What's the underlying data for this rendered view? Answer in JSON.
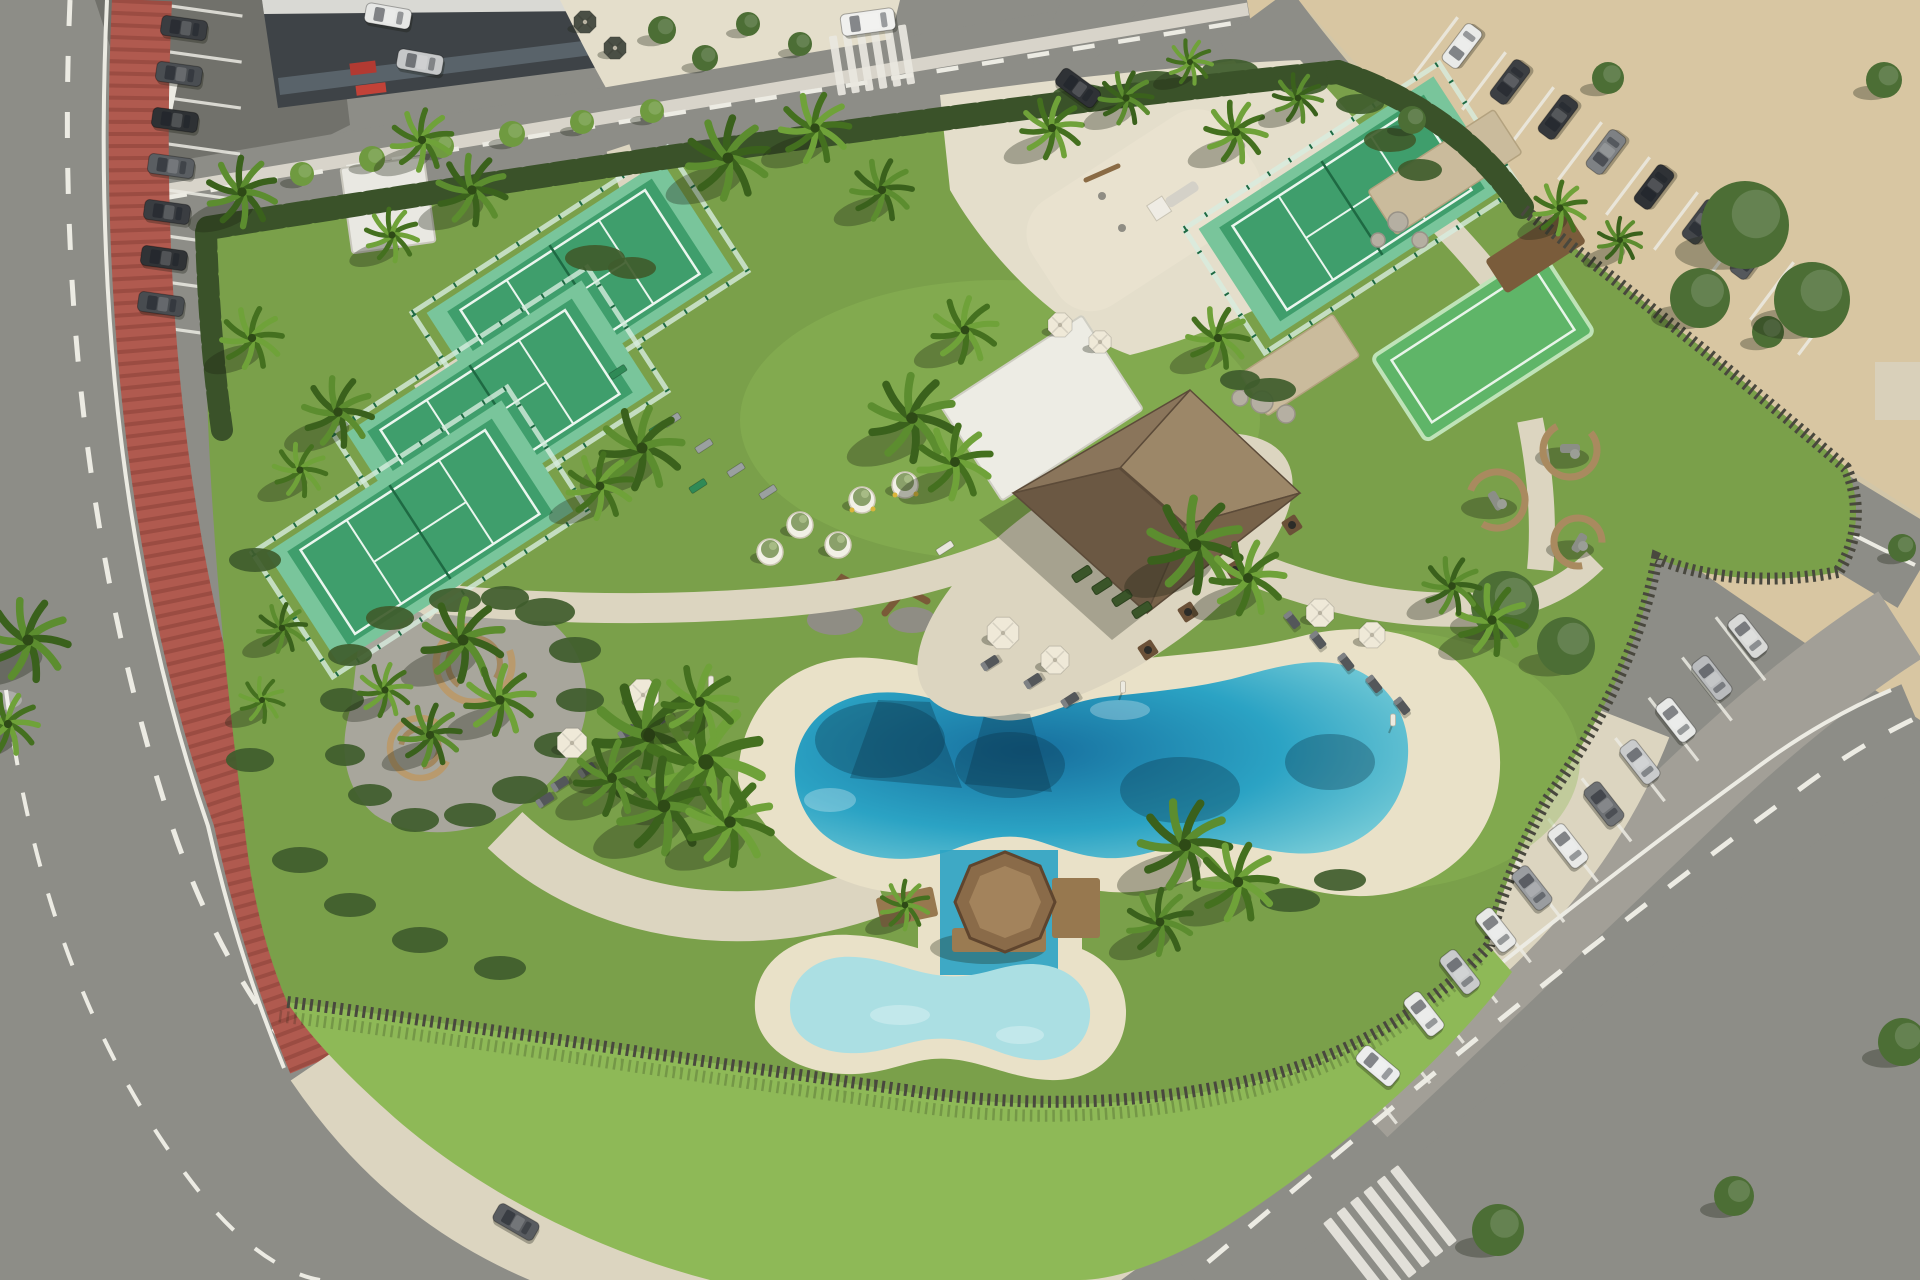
{
  "description": "Aerial drone view of a coastal resort leisure park with padel courts, lagoon pool, kids pool with octagonal wooden deck, thatched-roof pavilion, playground, palm trees, red bike lane on curved road, and car parking lots along a sandy beach strip",
  "palette": {
    "asphalt": "#80807a",
    "road": "#8d8d87",
    "asphalt_dark": "#71716b",
    "parking_light": "#a29f97",
    "sand_lot": "#d8c6a2",
    "walk": "#dcd5c0",
    "plaza": "#e4decb",
    "beach": "#e9e1c8",
    "grass": "#7aa04a",
    "grass_bright": "#8eb957",
    "grass_dark": "#5f853c",
    "hedge": "#3a5229",
    "shrub": "#3f5c2c",
    "fence": "#49483e",
    "bike": "#b05a4f",
    "road_line": "#ecebe3",
    "court_green": "#3f9e6c",
    "court_light": "#79c59b",
    "court_line": "#eaf6ee",
    "court_fence": "#1e6a43",
    "glass": "#d7ecdf",
    "pool_deep": "#176f9e",
    "pool_mid": "#2ba3c4",
    "pool_light": "#7fd0d9",
    "kids_pool": "#abdfe3",
    "wood": "#8e6f4e",
    "wood_dark": "#6b5138",
    "roof_n": "#9c8768",
    "roof_e": "#776249",
    "roof_s": "#6b5843",
    "roof_w": "#8a755b",
    "roof_edge": "#5c4b39",
    "bldg_white": "#edece4",
    "bldg_dark": "#3e4347",
    "glass_dark": "#59636a",
    "stone": "#cabb9c",
    "boulder": "#b5afa2",
    "gravel": "#a8a69c",
    "trunk": "#7d6b4c",
    "tree_dark": "#4c6e35",
    "tree_bright": "#6f9a40",
    "umbrella_cream": "#efe9d8",
    "umbrella_dark": "#4a4f45",
    "lounger": "#54575a",
    "red_accent": "#b23a32",
    "shadow": "rgba(28,33,18,0.32)"
  },
  "scene": {
    "palms": [
      [
        242,
        192,
        34,
        0
      ],
      [
        252,
        338,
        30,
        1
      ],
      [
        338,
        412,
        34,
        0
      ],
      [
        300,
        470,
        26,
        1
      ],
      [
        422,
        140,
        30,
        1
      ],
      [
        472,
        190,
        34,
        0
      ],
      [
        392,
        235,
        26,
        1
      ],
      [
        728,
        158,
        40,
        0
      ],
      [
        815,
        128,
        34,
        1
      ],
      [
        882,
        190,
        30,
        0
      ],
      [
        642,
        448,
        40,
        0
      ],
      [
        600,
        486,
        32,
        1
      ],
      [
        912,
        418,
        42,
        0
      ],
      [
        955,
        462,
        36,
        1
      ],
      [
        965,
        330,
        32,
        1
      ],
      [
        1052,
        128,
        30,
        1
      ],
      [
        1126,
        98,
        26,
        0
      ],
      [
        1236,
        132,
        30,
        1
      ],
      [
        1298,
        98,
        24,
        0
      ],
      [
        1190,
        62,
        22,
        1
      ],
      [
        1218,
        338,
        30,
        1
      ],
      [
        1195,
        545,
        46,
        0
      ],
      [
        1248,
        578,
        36,
        1
      ],
      [
        463,
        640,
        40,
        0
      ],
      [
        500,
        700,
        34,
        1
      ],
      [
        430,
        735,
        30,
        0
      ],
      [
        385,
        690,
        26,
        1
      ],
      [
        282,
        628,
        24,
        0
      ],
      [
        262,
        700,
        22,
        1
      ],
      [
        648,
        735,
        52,
        0
      ],
      [
        706,
        762,
        56,
        1
      ],
      [
        664,
        806,
        46,
        0
      ],
      [
        730,
        822,
        42,
        1
      ],
      [
        612,
        778,
        36,
        0
      ],
      [
        700,
        702,
        36,
        1
      ],
      [
        1185,
        845,
        44,
        0
      ],
      [
        1238,
        882,
        38,
        1
      ],
      [
        1160,
        922,
        32,
        0
      ],
      [
        1492,
        620,
        34,
        1
      ],
      [
        1452,
        586,
        28,
        0
      ],
      [
        1560,
        208,
        26,
        1
      ],
      [
        1620,
        240,
        22,
        0
      ],
      [
        28,
        640,
        40,
        0
      ],
      [
        8,
        724,
        30,
        1
      ],
      [
        905,
        905,
        24,
        1
      ]
    ],
    "trees": [
      [
        302,
        174,
        12,
        1
      ],
      [
        372,
        159,
        13,
        1
      ],
      [
        442,
        146,
        12,
        1
      ],
      [
        512,
        134,
        13,
        1
      ],
      [
        582,
        122,
        12,
        1
      ],
      [
        652,
        111,
        12,
        1
      ],
      [
        662,
        30,
        14,
        0
      ],
      [
        705,
        58,
        13,
        0
      ],
      [
        748,
        24,
        12,
        0
      ],
      [
        800,
        44,
        12,
        0
      ],
      [
        1608,
        78,
        16,
        0
      ],
      [
        1884,
        80,
        18,
        0
      ],
      [
        1768,
        332,
        16,
        0
      ],
      [
        1902,
        548,
        14,
        0
      ],
      [
        1745,
        225,
        44,
        0
      ],
      [
        1812,
        300,
        38,
        0
      ],
      [
        1700,
        298,
        30,
        0
      ],
      [
        1505,
        605,
        34,
        0
      ],
      [
        1566,
        646,
        29,
        0
      ],
      [
        1412,
        120,
        14,
        0
      ],
      [
        1498,
        1230,
        26,
        0
      ],
      [
        1734,
        1196,
        20,
        0
      ],
      [
        1902,
        1042,
        24,
        0
      ]
    ],
    "shrubs": [
      [
        545,
        612,
        30,
        14
      ],
      [
        575,
        650,
        26,
        13
      ],
      [
        580,
        700,
        24,
        12
      ],
      [
        560,
        745,
        26,
        13
      ],
      [
        520,
        790,
        28,
        14
      ],
      [
        470,
        815,
        26,
        12
      ],
      [
        415,
        820,
        24,
        12
      ],
      [
        370,
        795,
        22,
        11
      ],
      [
        345,
        755,
        20,
        11
      ],
      [
        342,
        700,
        22,
        12
      ],
      [
        350,
        655,
        22,
        11
      ],
      [
        390,
        618,
        24,
        12
      ],
      [
        455,
        600,
        26,
        12
      ],
      [
        505,
        598,
        24,
        12
      ],
      [
        595,
        258,
        30,
        13
      ],
      [
        632,
        268,
        24,
        11
      ],
      [
        1082,
        96,
        30,
        12
      ],
      [
        1156,
        82,
        28,
        11
      ],
      [
        1230,
        70,
        28,
        11
      ],
      [
        1302,
        84,
        26,
        11
      ],
      [
        1360,
        104,
        24,
        10
      ],
      [
        1390,
        140,
        26,
        12
      ],
      [
        1420,
        170,
        22,
        11
      ],
      [
        1270,
        390,
        26,
        12
      ],
      [
        1240,
        380,
        20,
        10
      ],
      [
        1290,
        900,
        30,
        12
      ],
      [
        1340,
        880,
        26,
        11
      ],
      [
        255,
        560,
        26,
        12
      ],
      [
        250,
        760,
        24,
        12
      ],
      [
        300,
        860,
        28,
        13
      ],
      [
        350,
        905,
        26,
        12
      ],
      [
        420,
        940,
        28,
        13
      ],
      [
        500,
        968,
        26,
        12
      ]
    ],
    "padel_courts": [
      {
        "x": 580,
        "y": 292,
        "rot": -33
      },
      {
        "x": 500,
        "y": 412,
        "rot": -33
      },
      {
        "x": 420,
        "y": 532,
        "rot": -33
      },
      {
        "x": 1352,
        "y": 208,
        "rot": -33
      }
    ],
    "cars": [
      [
        184,
        28,
        8,
        "#3a3d41"
      ],
      [
        179,
        74,
        8,
        "#4a4e52"
      ],
      [
        175,
        120,
        8,
        "#2e3134"
      ],
      [
        171,
        166,
        8,
        "#5a5e62"
      ],
      [
        167,
        212,
        8,
        "#3a3d41"
      ],
      [
        164,
        258,
        8,
        "#303336"
      ],
      [
        161,
        304,
        8,
        "#484c50"
      ],
      [
        420,
        62,
        10,
        "#c6c8c9"
      ],
      [
        388,
        16,
        10,
        "#e6e7e5"
      ],
      [
        868,
        22,
        -8,
        "#f0f0ee",
        "van"
      ],
      [
        1078,
        88,
        36,
        "#2f3236"
      ],
      [
        516,
        1222,
        30,
        "#595c60"
      ],
      [
        1462,
        46,
        -53,
        "#e9eae8"
      ],
      [
        1510,
        82,
        -53,
        "#3c3f43"
      ],
      [
        1558,
        117,
        -53,
        "#35383c"
      ],
      [
        1606,
        152,
        -53,
        "#7e8184"
      ],
      [
        1654,
        187,
        -53,
        "#2f3236"
      ],
      [
        1702,
        222,
        -53,
        "#43464a"
      ],
      [
        1750,
        257,
        -53,
        "#55585c"
      ],
      [
        1798,
        292,
        -53,
        "#303337"
      ],
      [
        1378,
        1066,
        40,
        "#eceded"
      ],
      [
        1424,
        1014,
        52,
        "#e8e9e7"
      ],
      [
        1460,
        972,
        52,
        "#c9cbcc"
      ],
      [
        1496,
        930,
        52,
        "#e8e9e7"
      ],
      [
        1532,
        888,
        52,
        "#9a9da0"
      ],
      [
        1568,
        846,
        52,
        "#e8e9e7"
      ],
      [
        1604,
        804,
        52,
        "#6e7174"
      ],
      [
        1640,
        762,
        52,
        "#c9cbcc"
      ],
      [
        1676,
        720,
        52,
        "#e8e9e7"
      ],
      [
        1712,
        678,
        52,
        "#b9bbbd"
      ],
      [
        1748,
        636,
        52,
        "#d8d9d7"
      ]
    ],
    "stall_rows": [
      {
        "x": 1372,
        "y": 1092,
        "dx": 33.5,
        "dy": -40.3,
        "n": 12,
        "rot": 52,
        "len": 80
      },
      {
        "x": 1436,
        "y": 46,
        "dx": 48,
        "dy": 35,
        "n": 9,
        "rot": -53,
        "len": 72
      },
      {
        "x": 185,
        "y": 8,
        "dx": -0.8,
        "dy": 46,
        "n": 8,
        "rot": 8,
        "len": 116
      }
    ],
    "crosswalks": [
      {
        "x": 872,
        "y": 60,
        "dir": -9,
        "n": 6,
        "step": 14,
        "bw": 8,
        "bl": 60
      },
      {
        "x": 1390,
        "y": 1232,
        "dir": -38,
        "n": 6,
        "step": 17,
        "bw": 10,
        "bl": 96
      }
    ],
    "umbrellas": [
      [
        643,
        695,
        17,
        "cream"
      ],
      [
        572,
        743,
        16,
        "cream"
      ],
      [
        1003,
        633,
        17,
        "cream"
      ],
      [
        1055,
        660,
        15,
        "cream"
      ],
      [
        1320,
        613,
        15,
        "cream"
      ],
      [
        1372,
        635,
        14,
        "cream"
      ],
      [
        1060,
        325,
        13,
        "cream"
      ],
      [
        1100,
        342,
        12,
        "cream"
      ],
      [
        585,
        22,
        12,
        "dark"
      ],
      [
        615,
        48,
        12,
        "dark"
      ]
    ],
    "loungers": [
      [
        663,
        718,
        -33
      ],
      [
        627,
        732,
        -33
      ],
      [
        587,
        770,
        -33
      ],
      [
        560,
        784,
        -33
      ],
      [
        545,
        800,
        -33
      ],
      [
        990,
        663,
        -33
      ],
      [
        1033,
        681,
        -33
      ],
      [
        1070,
        700,
        -33
      ],
      [
        1292,
        620,
        52
      ],
      [
        1318,
        640,
        52
      ],
      [
        1346,
        662,
        52
      ],
      [
        1374,
        684,
        52
      ],
      [
        1402,
        706,
        52
      ]
    ],
    "benches": [
      [
        618,
        372,
        -33,
        "g"
      ],
      [
        658,
        428,
        -33,
        "g"
      ],
      [
        698,
        486,
        -33,
        "g"
      ],
      [
        672,
        420,
        -33,
        "gy"
      ],
      [
        704,
        446,
        -33,
        "gy"
      ],
      [
        736,
        470,
        -33,
        "gy"
      ],
      [
        768,
        492,
        -33,
        "gy"
      ],
      [
        945,
        548,
        -33,
        "w"
      ]
    ],
    "planters": [
      [
        800,
        525,
        0
      ],
      [
        862,
        500,
        1
      ],
      [
        905,
        485,
        1
      ],
      [
        770,
        552,
        0
      ],
      [
        838,
        545,
        0
      ]
    ],
    "planter_boxes": [
      [
        1082,
        574
      ],
      [
        1102,
        586
      ],
      [
        1122,
        598
      ],
      [
        1142,
        610
      ]
    ],
    "fire_tables": [
      [
        1292,
        525
      ],
      [
        1235,
        570
      ],
      [
        1188,
        612
      ],
      [
        1148,
        650
      ]
    ],
    "seating_pods": [
      [
        1497,
        500,
        28,
        200
      ],
      [
        1570,
        450,
        27,
        320
      ],
      [
        1578,
        542,
        24,
        80
      ]
    ],
    "boulders": [
      [
        1398,
        222,
        10
      ],
      [
        1420,
        240,
        8
      ],
      [
        1378,
        240,
        7
      ],
      [
        1262,
        402,
        11
      ],
      [
        1286,
        414,
        9
      ],
      [
        1240,
        398,
        8
      ]
    ],
    "poles": [
      [
        711,
        685
      ],
      [
        1123,
        690
      ],
      [
        1393,
        723
      ]
    ]
  }
}
